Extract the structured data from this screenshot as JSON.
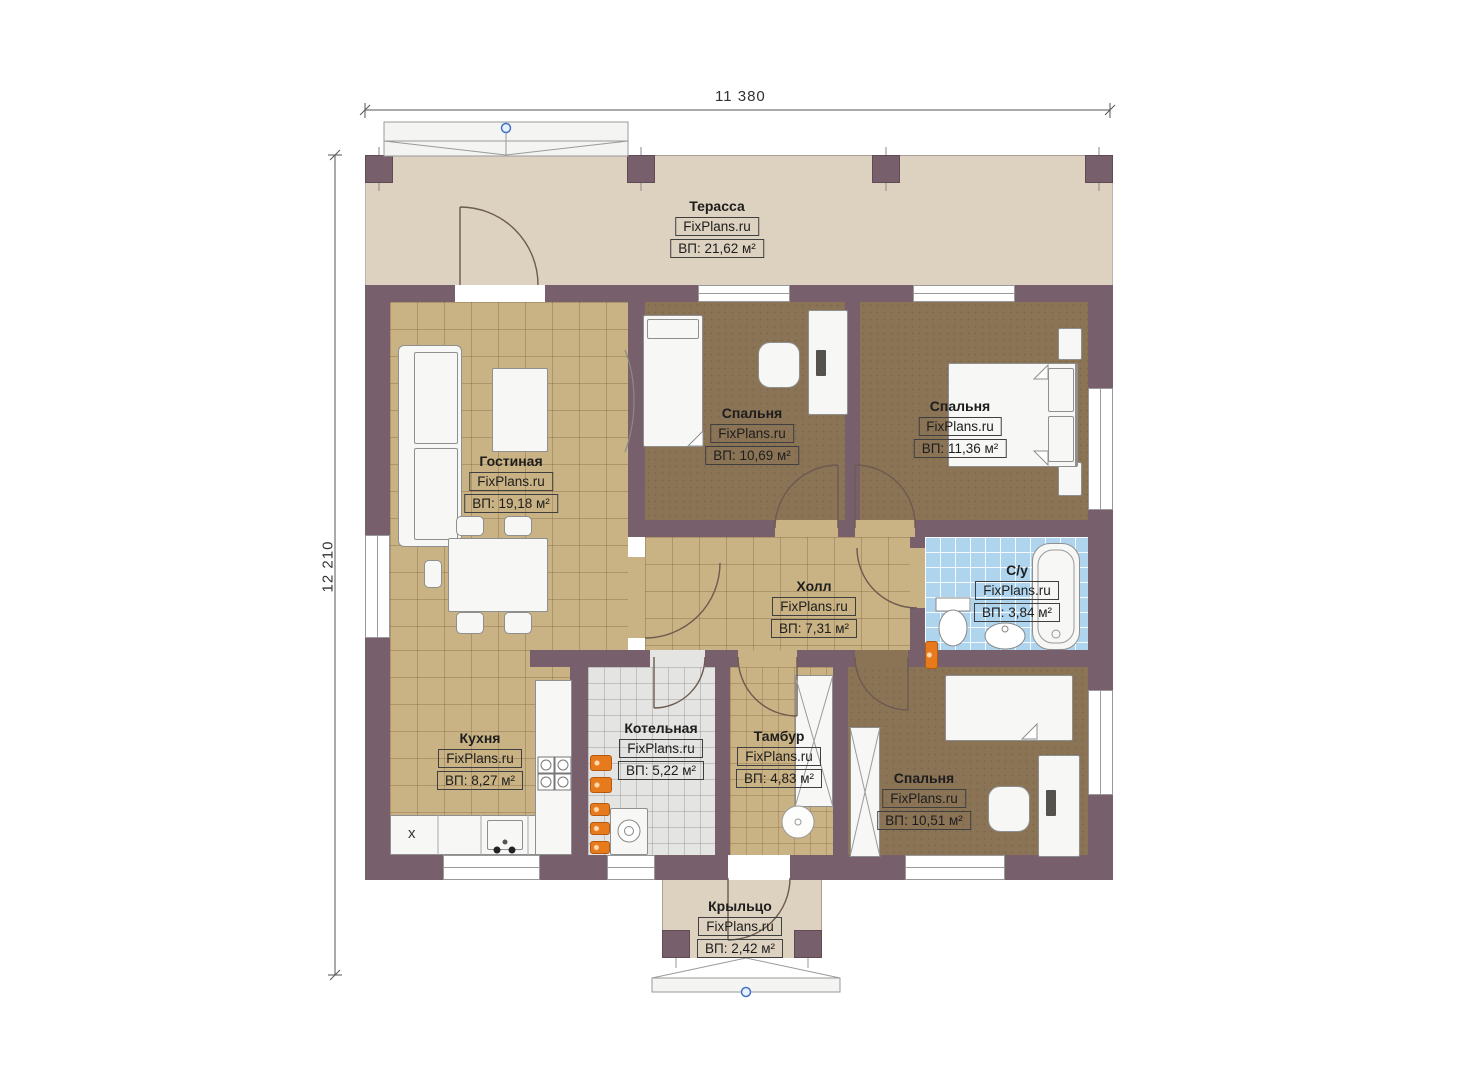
{
  "watermark": "FixPlans.ru",
  "dimensions": {
    "width": "11 380",
    "height": "12 210"
  },
  "rooms": {
    "terrace": {
      "name": "Терасса",
      "area": "ВП: 21,62 м²"
    },
    "living": {
      "name": "Гостиная",
      "area": "ВП: 19,18 м²"
    },
    "bedroom1": {
      "name": "Спальня",
      "area": "ВП: 10,69 м²"
    },
    "bedroom2": {
      "name": "Спальня",
      "area": "ВП: 11,36 м²"
    },
    "hall": {
      "name": "Холл",
      "area": "ВП: 7,31 м²"
    },
    "bathroom": {
      "name": "С/у",
      "area": "ВП: 3,84 м²"
    },
    "kitchen": {
      "name": "Кухня",
      "area": "ВП: 8,27 м²"
    },
    "boiler": {
      "name": "Котельная",
      "area": "ВП: 5,22 м²"
    },
    "tambour": {
      "name": "Тамбур",
      "area": "ВП: 4,83 м²"
    },
    "bedroom3": {
      "name": "Спальня",
      "area": "ВП: 10,51 м²"
    },
    "porch": {
      "name": "Крыльцо",
      "area": "ВП: 2,42 м²"
    }
  },
  "symbols": {
    "hob": "x"
  },
  "colors": {
    "wall": "#77606b",
    "floor_wood": "#c9b283",
    "floor_carpet": "#8b7456",
    "floor_tile_bath": "#aed4ee",
    "floor_tile_boiler": "#e4e4e2",
    "terrace_floor": "#ddd1c0",
    "accent_orange": "#e87a1e",
    "marker_blue": "#4472c4"
  }
}
